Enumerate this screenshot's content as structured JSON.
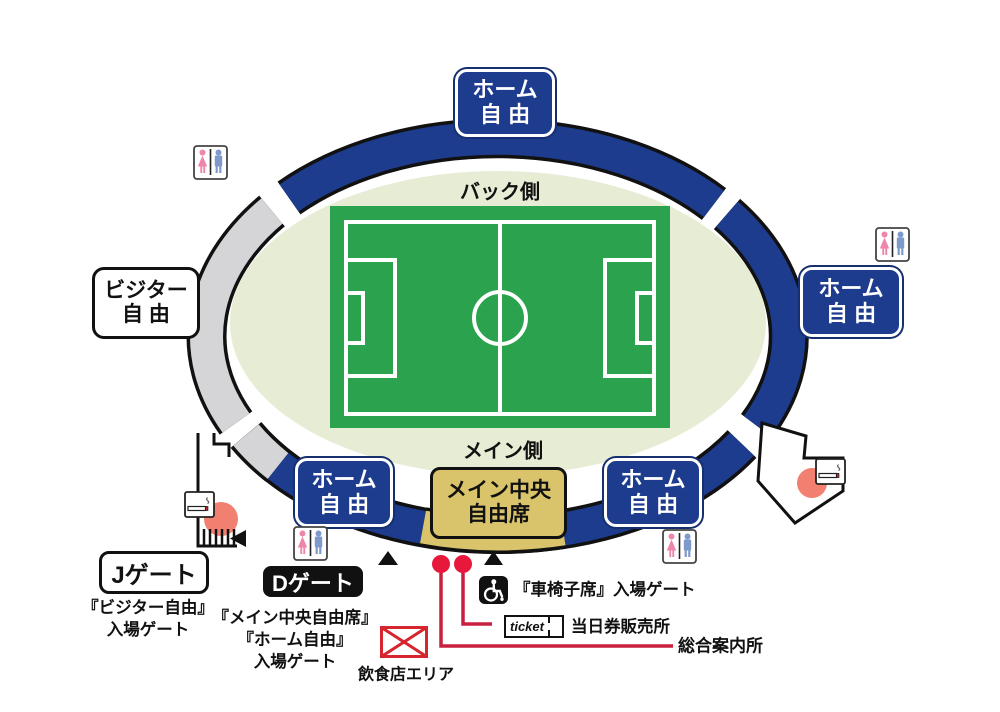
{
  "stands": {
    "home_top": [
      "ホーム",
      "自由"
    ],
    "home_right": [
      "ホーム",
      "自由"
    ],
    "visitor_left": [
      "ビジター",
      "自由"
    ],
    "home_bottom_left": [
      "ホーム",
      "自由"
    ],
    "home_bottom_right": [
      "ホーム",
      "自由"
    ],
    "main_center": [
      "メイン中央",
      "自由席"
    ]
  },
  "field": {
    "back_side": "バック側",
    "main_side": "メイン側"
  },
  "gates": {
    "j": {
      "label": "Jゲート",
      "desc": [
        "『ビジター自由』",
        "入場ゲート"
      ]
    },
    "d": {
      "label": "Dゲート",
      "desc": [
        "『メイン中央自由席』",
        "『ホーム自由』",
        "入場ゲート"
      ]
    },
    "wheelchair": {
      "label": "『車椅子席』入場ゲート"
    }
  },
  "services": {
    "ticket_box": "ticket",
    "ticket_sales": "当日券販売所",
    "info": "総合案内所",
    "food": "飲食店エリア"
  },
  "icons": {
    "restroom": "restroom-icon",
    "smoking": "smoking-area-icon",
    "wheelchair": "wheelchair-icon",
    "food": "food-area-envelope-icon",
    "ticket": "ticket-icon"
  },
  "colors": {
    "home_blue": "#1e3c8e",
    "visitor_gray": "#d5d5d7",
    "pitch_green": "#2ba24d",
    "field_light_green": "#e6edd4",
    "main_center_gold": "#d9c36b",
    "marker_red": "#d71f3e",
    "smoking_spot_salmon": "#f28070"
  }
}
